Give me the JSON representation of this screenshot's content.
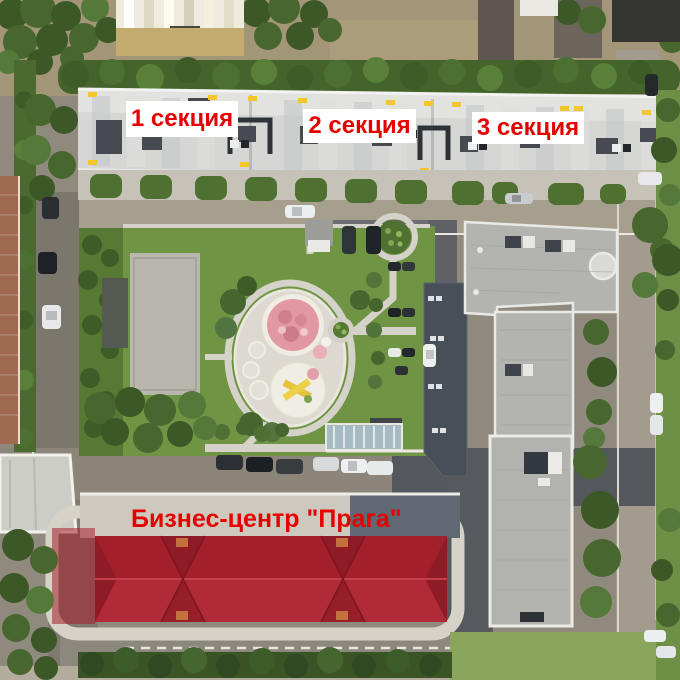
{
  "annotations": {
    "section_labels": [
      {
        "id": "section-1",
        "text": "1 секция"
      },
      {
        "id": "section-2",
        "text": "2 секция"
      },
      {
        "id": "section-3",
        "text": "3 секция"
      }
    ],
    "building_label": {
      "id": "business-center",
      "text": "Бизнес-центр \"Прага\""
    },
    "style": {
      "text_color": "#e60000",
      "box_background": "#ffffff"
    }
  },
  "scene_colors": {
    "highlighted_roof_red": "#a92230",
    "lawn_green": "#6f9444",
    "asphalt_gray": "#8b8679",
    "residential_roof": "#d6d7d5"
  }
}
